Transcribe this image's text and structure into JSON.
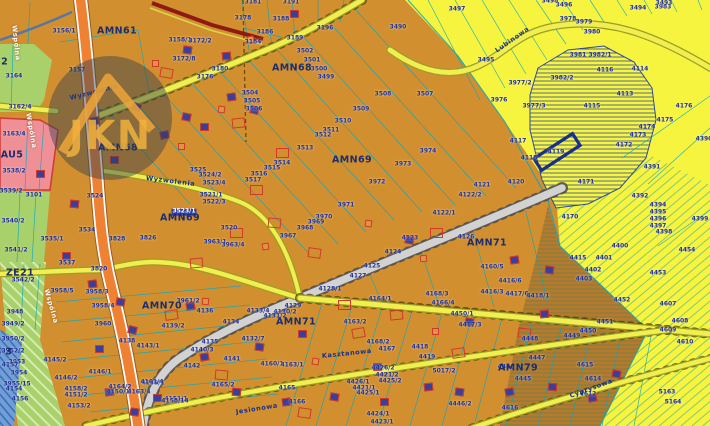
{
  "map": {
    "watermark": {
      "text": "JKN"
    },
    "colors": {
      "base_orange": "#d28f2f",
      "zone_yellow": "#f7f440",
      "parcel_line": "#05a7c5",
      "label_navy": "#1b2f9e",
      "selection_navy": "#24379c",
      "road_orange": "#ee8132",
      "road_yellow": "#f1ee52",
      "road_gray": "#d2d2d2",
      "water_blue": "#6f9fd6",
      "green_zone": "#a8d06b",
      "pink_zone": "#ef9096",
      "watermark_gold": "#edb23e",
      "boundary_red": "#8e1a12"
    },
    "zones": [
      [
        "AMN61",
        117,
        31
      ],
      [
        "AMN68",
        292,
        68
      ],
      [
        "AMN68",
        118,
        148
      ],
      [
        "AMN69",
        352,
        160
      ],
      [
        "AMN69",
        180,
        218
      ],
      [
        "AMN70",
        162,
        306
      ],
      [
        "AMN71",
        487,
        243
      ],
      [
        "AMN71",
        296,
        322
      ],
      [
        "AMN79",
        518,
        368
      ],
      [
        "ZE22",
        -6,
        62
      ],
      [
        "ZE21",
        20,
        273
      ],
      [
        "AU5",
        12,
        155
      ],
      [
        "WS 3",
        -2,
        352
      ]
    ],
    "streets": [
      [
        "Wspólna",
        14,
        22,
        84,
        "white"
      ],
      [
        "Wspólna",
        28,
        110,
        80,
        "white"
      ],
      [
        "Wspólna",
        46,
        286,
        74,
        "white"
      ],
      [
        "Wyzwolenia",
        70,
        95,
        -14,
        "navy"
      ],
      [
        "Wyzwolenia",
        146,
        175,
        7,
        "navy"
      ],
      [
        "Lubinowa",
        496,
        48,
        -35,
        "navy"
      ],
      [
        "Kasztanowa",
        322,
        353,
        -6,
        "navy"
      ],
      [
        "Cyprysowa",
        570,
        393,
        -20,
        "navy"
      ],
      [
        "Jesionowa",
        236,
        409,
        -9,
        "navy"
      ]
    ],
    "parcels": [
      [
        "3156/1",
        64,
        32
      ],
      [
        "3157",
        77,
        71
      ],
      [
        "3158/1",
        180,
        41
      ],
      [
        "3172/2",
        200,
        42
      ],
      [
        "3172/8",
        184,
        60
      ],
      [
        "3176",
        205,
        78
      ],
      [
        "3180",
        220,
        70
      ],
      [
        "3178",
        243,
        19
      ],
      [
        "3181",
        253,
        3
      ],
      [
        "3191",
        291,
        3
      ],
      [
        "3188",
        281,
        20
      ],
      [
        "3186",
        265,
        33
      ],
      [
        "3184",
        253,
        43
      ],
      [
        "3189",
        295,
        39
      ],
      [
        "3196",
        325,
        29
      ],
      [
        "3164",
        14,
        77
      ],
      [
        "3162/4",
        20,
        108
      ],
      [
        "3163/4",
        14,
        135
      ],
      [
        "3538/2",
        14,
        172
      ],
      [
        "3101",
        34,
        196
      ],
      [
        "3539/2",
        11,
        192
      ],
      [
        "3540/2",
        13,
        222
      ],
      [
        "3541/2",
        16,
        251
      ],
      [
        "3542/2",
        23,
        281
      ],
      [
        "3535/1",
        52,
        240
      ],
      [
        "3524",
        95,
        197
      ],
      [
        "3534",
        87,
        231
      ],
      [
        "3537",
        67,
        264
      ],
      [
        "3828",
        117,
        240
      ],
      [
        "3826",
        148,
        239
      ],
      [
        "3820",
        99,
        270
      ],
      [
        "3525",
        198,
        171
      ],
      [
        "3524/2",
        210,
        176
      ],
      [
        "3523/4",
        214,
        184
      ],
      [
        "3523/1",
        184,
        212,
        1
      ],
      [
        "3522/3",
        214,
        203
      ],
      [
        "3521/1",
        211,
        196
      ],
      [
        "3520",
        229,
        229
      ],
      [
        "3963/1",
        215,
        243
      ],
      [
        "3963/4",
        233,
        246
      ],
      [
        "3948",
        15,
        313
      ],
      [
        "3949/2",
        13,
        325
      ],
      [
        "3950/2",
        13,
        340
      ],
      [
        "3952/2",
        13,
        352
      ],
      [
        "3953",
        17,
        363
      ],
      [
        "3954",
        19,
        374
      ],
      [
        "3955/15",
        17,
        385
      ],
      [
        "4157",
        10,
        366
      ],
      [
        "4154",
        14,
        390
      ],
      [
        "4156",
        20,
        400
      ],
      [
        "3958/5",
        62,
        292
      ],
      [
        "3958/3",
        97,
        293
      ],
      [
        "3958/4",
        103,
        307
      ],
      [
        "3960",
        103,
        325
      ],
      [
        "3961/2",
        188,
        302
      ],
      [
        "4145/2",
        55,
        361
      ],
      [
        "4146/2",
        66,
        379
      ],
      [
        "4146/1",
        100,
        373
      ],
      [
        "4138",
        127,
        342
      ],
      [
        "4143/1",
        148,
        347
      ],
      [
        "4158/2",
        76,
        390
      ],
      [
        "4151/2",
        76,
        396
      ],
      [
        "4153/2",
        79,
        407
      ],
      [
        "4150/1",
        118,
        393
      ],
      [
        "4149/1",
        153,
        384
      ],
      [
        "4151/1",
        176,
        400
      ],
      [
        "4142",
        192,
        367
      ],
      [
        "4140/3",
        202,
        351
      ],
      [
        "4141",
        232,
        360
      ],
      [
        "4135",
        210,
        343
      ],
      [
        "4136",
        205,
        312
      ],
      [
        "4134",
        231,
        323
      ],
      [
        "4139/2",
        173,
        327
      ],
      [
        "3502",
        305,
        52
      ],
      [
        "3501",
        312,
        61
      ],
      [
        "3500",
        319,
        70
      ],
      [
        "3499",
        326,
        78
      ],
      [
        "3504",
        250,
        94
      ],
      [
        "3505",
        252,
        102
      ],
      [
        "3506",
        254,
        110
      ],
      [
        "3490",
        398,
        28
      ],
      [
        "3507",
        425,
        95
      ],
      [
        "3508",
        383,
        95
      ],
      [
        "3509",
        361,
        110
      ],
      [
        "3510",
        343,
        122
      ],
      [
        "3511",
        331,
        131
      ],
      [
        "3512",
        323,
        136
      ],
      [
        "3513",
        305,
        149
      ],
      [
        "3514",
        282,
        164
      ],
      [
        "3515",
        272,
        169
      ],
      [
        "3516",
        259,
        175
      ],
      [
        "3517",
        253,
        181
      ],
      [
        "3971",
        346,
        206
      ],
      [
        "3972",
        377,
        183
      ],
      [
        "3973",
        403,
        165
      ],
      [
        "3974",
        428,
        152
      ],
      [
        "3970",
        324,
        218
      ],
      [
        "3969",
        316,
        223
      ],
      [
        "3968",
        305,
        229
      ],
      [
        "3967",
        288,
        237
      ],
      [
        "4121",
        482,
        186
      ],
      [
        "4122/2",
        470,
        196
      ],
      [
        "4122/1",
        444,
        214
      ],
      [
        "4123",
        410,
        239
      ],
      [
        "4126",
        466,
        238
      ],
      [
        "4124",
        393,
        253
      ],
      [
        "4125",
        372,
        267
      ],
      [
        "4127",
        358,
        277
      ],
      [
        "4128/1",
        330,
        290
      ],
      [
        "4129",
        293,
        307
      ],
      [
        "4130/2",
        285,
        313
      ],
      [
        "4131/2",
        275,
        317
      ],
      [
        "4133/4",
        258,
        312
      ],
      [
        "4132/7",
        253,
        340
      ],
      [
        "4163/2",
        355,
        323
      ],
      [
        "4164/1",
        380,
        300
      ],
      [
        "4168/3",
        437,
        295
      ],
      [
        "4166/4",
        443,
        304
      ],
      [
        "4450/1",
        462,
        315
      ],
      [
        "4417/3",
        470,
        326
      ],
      [
        "4160/1",
        272,
        365
      ],
      [
        "4163/1",
        292,
        366
      ],
      [
        "4168/2",
        378,
        343
      ],
      [
        "4167",
        387,
        350
      ],
      [
        "4418",
        420,
        348
      ],
      [
        "4419",
        427,
        358
      ],
      [
        "4426/2",
        383,
        369
      ],
      [
        "4421/2",
        387,
        376
      ],
      [
        "4425/2",
        390,
        382
      ],
      [
        "4426/1",
        358,
        383
      ],
      [
        "4421/1",
        364,
        389
      ],
      [
        "4425/1",
        368,
        394
      ],
      [
        "4424/1",
        378,
        415
      ],
      [
        "4423/1",
        382,
        423
      ],
      [
        "5017/2",
        444,
        372
      ],
      [
        "4446/2",
        460,
        405
      ],
      [
        "4165",
        287,
        389
      ],
      [
        "4166",
        297,
        403
      ],
      [
        "4164/2",
        120,
        388
      ],
      [
        "4163/4",
        139,
        393
      ],
      [
        "4161/4",
        152,
        383
      ],
      [
        "4158/14",
        175,
        402
      ],
      [
        "4165/2",
        223,
        386
      ],
      [
        "4160/5",
        492,
        268
      ],
      [
        "4416/6",
        510,
        282
      ],
      [
        "4416/3",
        492,
        293
      ],
      [
        "4417/6",
        517,
        295
      ],
      [
        "4418/1",
        538,
        297
      ],
      [
        "4415",
        578,
        259
      ],
      [
        "4400",
        620,
        247
      ],
      [
        "4401",
        604,
        259
      ],
      [
        "4402",
        593,
        271
      ],
      [
        "4403",
        584,
        280
      ],
      [
        "4392",
        640,
        197
      ],
      [
        "4394",
        658,
        206
      ],
      [
        "4395",
        658,
        213
      ],
      [
        "4396",
        658,
        220
      ],
      [
        "4397",
        658,
        227
      ],
      [
        "4398",
        664,
        233
      ],
      [
        "4399",
        700,
        220
      ],
      [
        "4454",
        687,
        251
      ],
      [
        "4453",
        658,
        274
      ],
      [
        "4170",
        570,
        218
      ],
      [
        "4171",
        586,
        183
      ],
      [
        "4120",
        516,
        183
      ],
      [
        "4119",
        556,
        153
      ],
      [
        "4118",
        529,
        159
      ],
      [
        "4117",
        518,
        142
      ],
      [
        "4172",
        624,
        146
      ],
      [
        "4173",
        638,
        136
      ],
      [
        "4174",
        647,
        128
      ],
      [
        "4175",
        665,
        121
      ],
      [
        "4176",
        684,
        107
      ],
      [
        "4390",
        704,
        140
      ],
      [
        "4391",
        652,
        168
      ],
      [
        "4113",
        625,
        95
      ],
      [
        "4114",
        640,
        70
      ],
      [
        "4115",
        592,
        107
      ],
      [
        "4116",
        605,
        71
      ],
      [
        "3983",
        663,
        8
      ],
      [
        "3978",
        568,
        20
      ],
      [
        "3979",
        584,
        23
      ],
      [
        "3980",
        592,
        33
      ],
      [
        "3981",
        578,
        56
      ],
      [
        "3982/1",
        600,
        56
      ],
      [
        "3982/2",
        562,
        79
      ],
      [
        "3977/2",
        520,
        84
      ],
      [
        "3976",
        499,
        101
      ],
      [
        "3977/3",
        534,
        107
      ],
      [
        "3495",
        486,
        61
      ],
      [
        "3497",
        457,
        10
      ],
      [
        "3496",
        564,
        6
      ],
      [
        "3493",
        664,
        4
      ],
      [
        "3494",
        638,
        9
      ],
      [
        "3498",
        550,
        2
      ],
      [
        "4452",
        622,
        301
      ],
      [
        "4451",
        605,
        323
      ],
      [
        "4450",
        588,
        332
      ],
      [
        "4449",
        572,
        337
      ],
      [
        "4448",
        530,
        340
      ],
      [
        "4447",
        537,
        359
      ],
      [
        "4446",
        506,
        368
      ],
      [
        "4445",
        523,
        380
      ],
      [
        "4616",
        510,
        409
      ],
      [
        "4615",
        585,
        366
      ],
      [
        "4614",
        593,
        380
      ],
      [
        "4612",
        588,
        395
      ],
      [
        "4610",
        685,
        343
      ],
      [
        "4607",
        668,
        305
      ],
      [
        "4608",
        680,
        322
      ],
      [
        "4609",
        668,
        331
      ],
      [
        "5163",
        667,
        393
      ],
      [
        "5164",
        673,
        403
      ]
    ],
    "buildings": [
      [
        "b",
        183,
        46,
        8
      ],
      [
        "b",
        222,
        52,
        -5
      ],
      [
        "b",
        290,
        10,
        0
      ],
      [
        "b",
        132,
        103,
        20
      ],
      [
        "b",
        90,
        117,
        -10
      ],
      [
        "b",
        182,
        113,
        12
      ],
      [
        "b",
        110,
        156,
        0
      ],
      [
        "b",
        227,
        93,
        -8
      ],
      [
        "b",
        250,
        106,
        15
      ],
      [
        "b",
        200,
        123,
        0
      ],
      [
        "b",
        160,
        131,
        -12
      ],
      [
        "b",
        70,
        200,
        5
      ],
      [
        "b",
        62,
        252,
        0
      ],
      [
        "b",
        36,
        170,
        0
      ],
      [
        "b",
        88,
        280,
        -8
      ],
      [
        "b",
        116,
        298,
        10
      ],
      [
        "b",
        95,
        345,
        0
      ],
      [
        "b",
        128,
        326,
        14
      ],
      [
        "b",
        105,
        388,
        -6
      ],
      [
        "b",
        130,
        408,
        8
      ],
      [
        "b",
        153,
        394,
        0
      ],
      [
        "b",
        186,
        302,
        -10
      ],
      [
        "b",
        405,
        236,
        12
      ],
      [
        "b",
        510,
        256,
        -8
      ],
      [
        "b",
        545,
        266,
        6
      ],
      [
        "b",
        373,
        363,
        0
      ],
      [
        "b",
        465,
        318,
        10
      ],
      [
        "b",
        540,
        310,
        -5
      ],
      [
        "b",
        255,
        343,
        8
      ],
      [
        "b",
        200,
        353,
        -10
      ],
      [
        "b",
        232,
        388,
        5
      ],
      [
        "b",
        282,
        398,
        -8
      ],
      [
        "b",
        330,
        393,
        10
      ],
      [
        "b",
        380,
        398,
        0
      ],
      [
        "b",
        424,
        383,
        -6
      ],
      [
        "b",
        455,
        388,
        8
      ],
      [
        "b",
        505,
        388,
        -10
      ],
      [
        "b",
        548,
        383,
        5
      ],
      [
        "b",
        588,
        394,
        -8
      ],
      [
        "b",
        612,
        370,
        10
      ],
      [
        "b",
        298,
        330,
        0
      ],
      [
        "o",
        152,
        60,
        0
      ],
      [
        "o",
        247,
        36,
        -10
      ],
      [
        "o",
        218,
        106,
        8
      ],
      [
        "o",
        178,
        143,
        0
      ],
      [
        "o",
        262,
        243,
        -8
      ],
      [
        "o",
        312,
        358,
        10
      ],
      [
        "o",
        432,
        328,
        0
      ],
      [
        "o",
        202,
        298,
        6
      ],
      [
        "o",
        420,
        255,
        -5
      ],
      [
        "o",
        365,
        220,
        8
      ],
      [
        "r",
        160,
        68,
        10
      ],
      [
        "r",
        232,
        118,
        -6
      ],
      [
        "r",
        276,
        148,
        0
      ],
      [
        "r",
        298,
        408,
        8
      ],
      [
        "r",
        352,
        328,
        -10
      ],
      [
        "r",
        268,
        218,
        5
      ],
      [
        "r",
        430,
        228,
        0
      ],
      [
        "r",
        452,
        348,
        -8
      ],
      [
        "r",
        518,
        328,
        6
      ],
      [
        "r",
        230,
        228,
        0
      ],
      [
        "r",
        190,
        258,
        -5
      ],
      [
        "r",
        308,
        248,
        8
      ],
      [
        "r",
        250,
        185,
        0
      ],
      [
        "r",
        165,
        310,
        -8
      ],
      [
        "r",
        215,
        370,
        5
      ],
      [
        "r",
        338,
        300,
        0
      ],
      [
        "r",
        390,
        310,
        -6
      ]
    ]
  }
}
